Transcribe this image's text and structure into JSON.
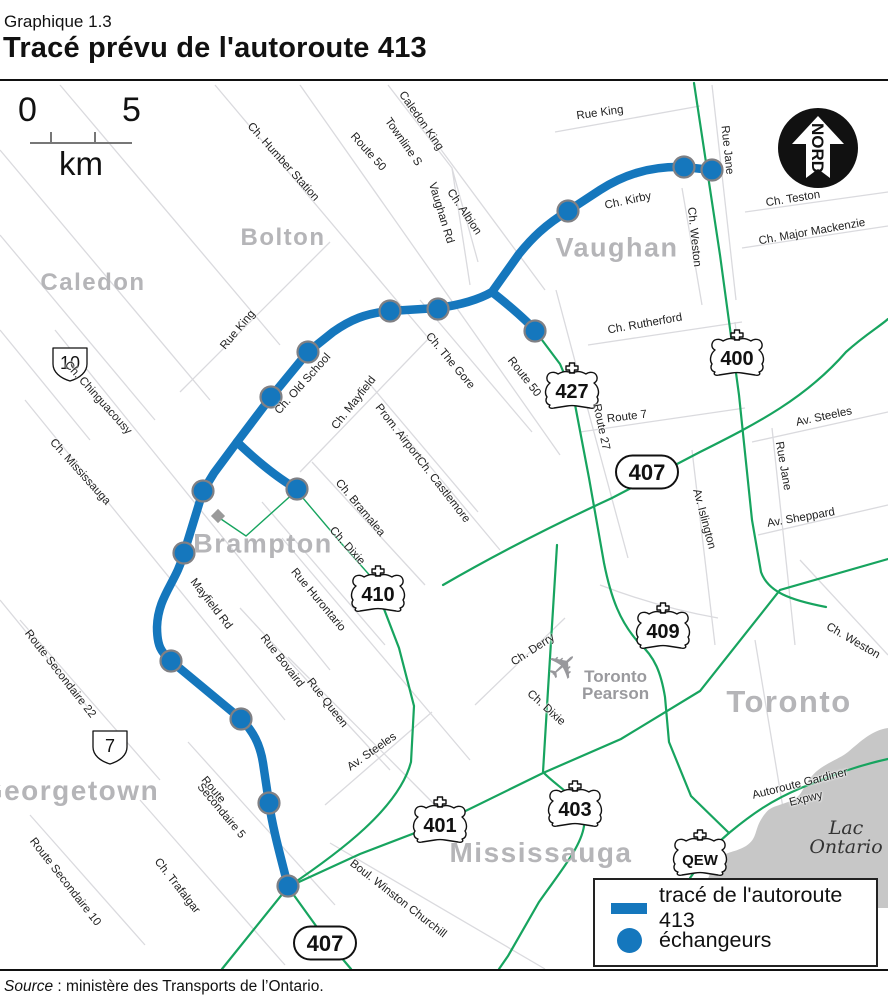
{
  "header": {
    "kicker": "Graphique 1.3",
    "title": "Tracé prévu de l'autoroute 413"
  },
  "source": {
    "label": "Source",
    "text": " : ministère des Transports de l’Ontario."
  },
  "scale_bar": {
    "start": "0",
    "end": "5",
    "unit": "km"
  },
  "north_arrow": {
    "label": "NORD"
  },
  "legend": {
    "route": "tracé de l'autoroute 413",
    "interchanges": "échangeurs"
  },
  "lake": {
    "line1": "Lac",
    "line2": "Ontario"
  },
  "airport": {
    "line1": "Toronto",
    "line2": "Pearson"
  },
  "colors": {
    "route_blue": "#1577bd",
    "highway_green": "#17a45f",
    "minor_road": "#dadade",
    "city_gray": "#b5b5b8",
    "lake_gray": "#c7c7c7"
  },
  "map": {
    "cities": [
      {
        "name": "Caledon",
        "x": 93,
        "y": 283,
        "size": 24
      },
      {
        "name": "Bolton",
        "x": 283,
        "y": 238,
        "size": 24
      },
      {
        "name": "Vaughan",
        "x": 617,
        "y": 248,
        "size": 27
      },
      {
        "name": "Brampton",
        "x": 263,
        "y": 544,
        "size": 27
      },
      {
        "name": "Georgetown",
        "x": 70,
        "y": 791,
        "size": 28
      },
      {
        "name": "Mississauga",
        "x": 541,
        "y": 853,
        "size": 28
      },
      {
        "name": "Toronto",
        "x": 789,
        "y": 702,
        "size": 31
      }
    ],
    "road_labels": [
      {
        "text": "Rue King",
        "x": 600,
        "y": 113,
        "rot": -8
      },
      {
        "text": "Rue Jane",
        "x": 727,
        "y": 150,
        "rot": 84
      },
      {
        "text": "Caledon King",
        "x": 421,
        "y": 121,
        "rot": 55
      },
      {
        "text": "Townline S",
        "x": 403,
        "y": 142,
        "rot": 55
      },
      {
        "text": "Ch. Humber Station",
        "x": 283,
        "y": 162,
        "rot": 48
      },
      {
        "text": "Route 50",
        "x": 368,
        "y": 152,
        "rot": 48
      },
      {
        "text": "Ch. Albion",
        "x": 464,
        "y": 212,
        "rot": 56
      },
      {
        "text": "Vaughan Rd",
        "x": 441,
        "y": 213,
        "rot": 73
      },
      {
        "text": "Ch. Kirby",
        "x": 628,
        "y": 201,
        "rot": -12
      },
      {
        "text": "Ch. Weston",
        "x": 694,
        "y": 237,
        "rot": 84
      },
      {
        "text": "Ch. Teston",
        "x": 793,
        "y": 199,
        "rot": -9
      },
      {
        "text": "Ch. Major Mackenzie",
        "x": 812,
        "y": 232,
        "rot": -10
      },
      {
        "text": "Ch. Rutherford",
        "x": 645,
        "y": 324,
        "rot": -10
      },
      {
        "text": "Route 50",
        "x": 524,
        "y": 377,
        "rot": 52
      },
      {
        "text": "Route 27",
        "x": 601,
        "y": 427,
        "rot": 78
      },
      {
        "text": "Route 7",
        "x": 627,
        "y": 417,
        "rot": -7
      },
      {
        "text": "Av. Steeles",
        "x": 824,
        "y": 417,
        "rot": -12
      },
      {
        "text": "Rue Jane",
        "x": 783,
        "y": 466,
        "rot": 80
      },
      {
        "text": "Av. Islington",
        "x": 704,
        "y": 519,
        "rot": 75
      },
      {
        "text": "Av. Sheppard",
        "x": 801,
        "y": 518,
        "rot": -10
      },
      {
        "text": "Rue King",
        "x": 238,
        "y": 330,
        "rot": -50
      },
      {
        "text": "Ch. Old School",
        "x": 303,
        "y": 384,
        "rot": -48
      },
      {
        "text": "Ch. Mayfield",
        "x": 354,
        "y": 403,
        "rot": -52
      },
      {
        "text": "Prom. Airport",
        "x": 398,
        "y": 432,
        "rot": 52
      },
      {
        "text": "Ch. The Gore",
        "x": 450,
        "y": 361,
        "rot": 50
      },
      {
        "text": "Ch. Castlemore",
        "x": 443,
        "y": 490,
        "rot": 52
      },
      {
        "text": "Ch. Bramalea",
        "x": 360,
        "y": 508,
        "rot": 50
      },
      {
        "text": "Ch. Dixie",
        "x": 347,
        "y": 546,
        "rot": 48
      },
      {
        "text": "Ch. Chinguacousy",
        "x": 98,
        "y": 398,
        "rot": 48
      },
      {
        "text": "Ch. Mississauga",
        "x": 80,
        "y": 472,
        "rot": 48
      },
      {
        "text": "Mayfield Rd",
        "x": 211,
        "y": 604,
        "rot": 52
      },
      {
        "text": "Rue Hurontario",
        "x": 318,
        "y": 600,
        "rot": 50
      },
      {
        "text": "Rue Bovaird",
        "x": 282,
        "y": 661,
        "rot": 52
      },
      {
        "text": "Rue Queen",
        "x": 327,
        "y": 703,
        "rot": 52
      },
      {
        "text": "Route Secondaire 22",
        "x": 60,
        "y": 674,
        "rot": 52
      },
      {
        "text": "Av. Steeles",
        "x": 372,
        "y": 752,
        "rot": -35
      },
      {
        "text": "Route",
        "x": 213,
        "y": 790,
        "rot": 50
      },
      {
        "text": "Secondaire 5",
        "x": 221,
        "y": 811,
        "rot": 50
      },
      {
        "text": "Route Secondaire 10",
        "x": 65,
        "y": 882,
        "rot": 52
      },
      {
        "text": "Ch. Trafalgar",
        "x": 177,
        "y": 886,
        "rot": 52
      },
      {
        "text": "Boul. Winston Churchill",
        "x": 398,
        "y": 899,
        "rot": 38
      },
      {
        "text": "Ch. Derry",
        "x": 533,
        "y": 650,
        "rot": -33
      },
      {
        "text": "Ch. Dixie",
        "x": 546,
        "y": 708,
        "rot": 42
      },
      {
        "text": "Ch. Weston",
        "x": 853,
        "y": 641,
        "rot": 30
      },
      {
        "text": "Autoroute Gardiner",
        "x": 800,
        "y": 784,
        "rot": -14
      },
      {
        "text": "Expwy",
        "x": 806,
        "y": 799,
        "rot": -14
      }
    ],
    "shields": [
      {
        "label": "400",
        "type": "crown",
        "x": 737,
        "y": 355
      },
      {
        "label": "427",
        "type": "crown",
        "x": 572,
        "y": 388
      },
      {
        "label": "410",
        "type": "crown",
        "x": 378,
        "y": 591
      },
      {
        "label": "409",
        "type": "crown",
        "x": 663,
        "y": 628
      },
      {
        "label": "401",
        "type": "crown",
        "x": 440,
        "y": 822
      },
      {
        "label": "403",
        "type": "crown",
        "x": 575,
        "y": 806
      },
      {
        "label": "QEW",
        "type": "crown",
        "x": 700,
        "y": 855
      },
      {
        "label": "407",
        "type": "oval",
        "x": 647,
        "y": 472
      },
      {
        "label": "407",
        "type": "oval",
        "x": 325,
        "y": 943
      },
      {
        "label": "10",
        "type": "badge",
        "x": 70,
        "y": 362
      },
      {
        "label": "7",
        "type": "badge",
        "x": 110,
        "y": 745
      }
    ],
    "interchanges": [
      [
        712,
        170
      ],
      [
        684,
        167
      ],
      [
        568,
        211
      ],
      [
        535,
        331
      ],
      [
        438,
        309
      ],
      [
        390,
        311
      ],
      [
        308,
        352
      ],
      [
        271,
        397
      ],
      [
        297,
        489
      ],
      [
        203,
        491
      ],
      [
        184,
        553
      ],
      [
        171,
        661
      ],
      [
        241,
        719
      ],
      [
        269,
        803
      ],
      [
        288,
        886
      ]
    ]
  }
}
